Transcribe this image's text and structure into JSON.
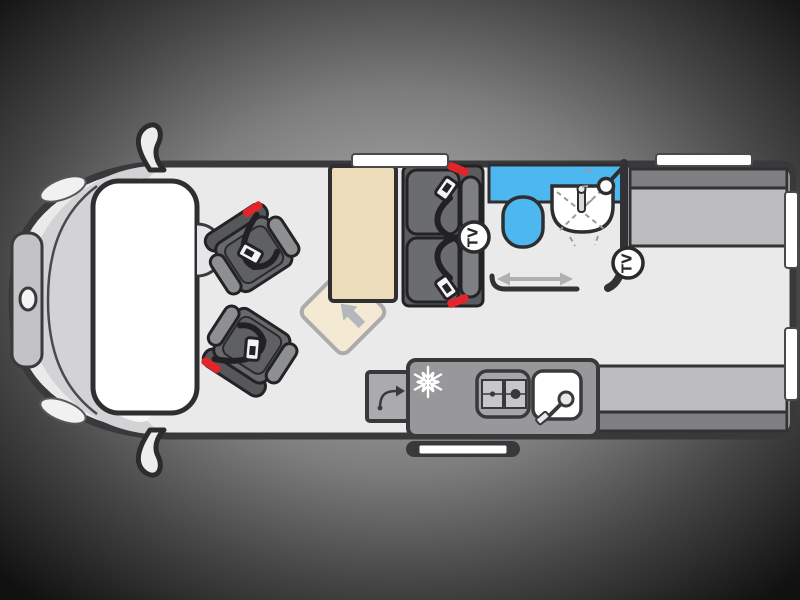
{
  "title": "Campervan floor plan diagram",
  "labels": {
    "tv": "TV"
  },
  "colors": {
    "fixture_blue": "#4db7ef",
    "accent_red": "#e2252b",
    "table_beige": "#ecdcba",
    "flap_beige": "#f4ead3",
    "bench_gray": "#bcbcbe",
    "backrest_gray": "#7f7f82",
    "counter_gray": "#98989b",
    "seat_dark": "#66676a",
    "floor_light": "#eaeaeb",
    "wall_dark": "#39393b"
  },
  "icons": [
    "tv-badge",
    "snowflake-icon",
    "shower-head-icon",
    "tap-icon",
    "hob-icon",
    "sliding-door-arrow-icon",
    "table-extend-arrow-icon",
    "worktop-swing-arrow-icon",
    "seatbelt-icon"
  ]
}
